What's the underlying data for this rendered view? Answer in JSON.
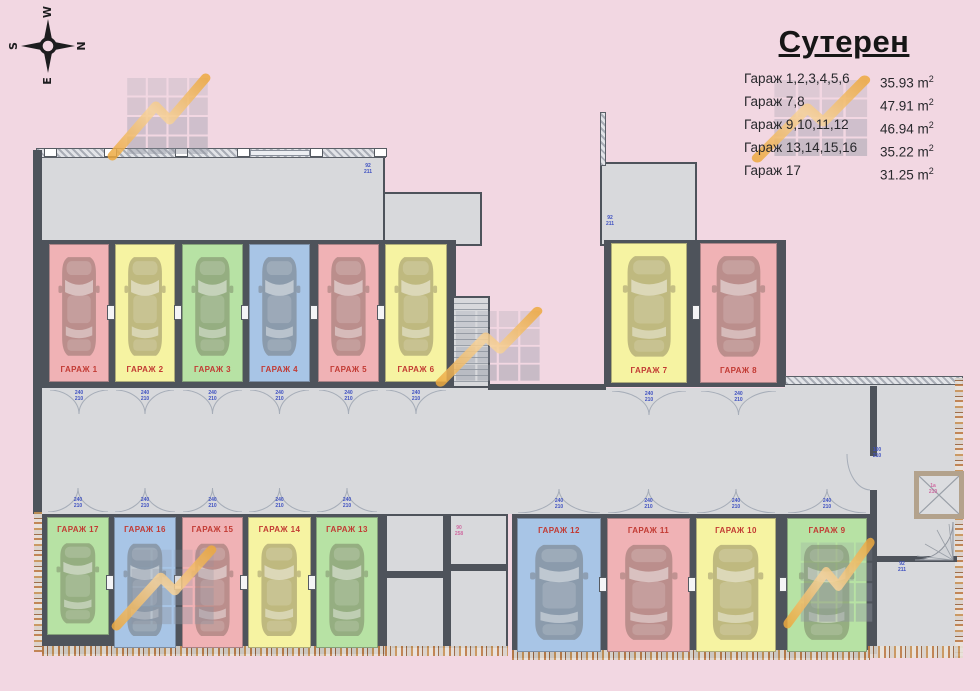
{
  "legend": {
    "title": "Сутерен",
    "unit": "m",
    "sup": "2",
    "rows": [
      {
        "label": "Гараж 1,2,3,4,5,6",
        "value": "35.93"
      },
      {
        "label": "Гараж 7,8",
        "value": "47.91"
      },
      {
        "label": "Гараж 9,10,11,12",
        "value": "46.94"
      },
      {
        "label": "Гараж 13,14,15,16",
        "value": "35.22"
      },
      {
        "label": "Гараж 17",
        "value": "31.25"
      }
    ]
  },
  "compass": {
    "top": "W",
    "right": "N",
    "bottom": "E",
    "left": "S"
  },
  "colors": {
    "red": "#f0b2b5",
    "yellow": "#f6f3a2",
    "green": "#b7e2a4",
    "blue": "#a8c5e6",
    "label": "#c23a33",
    "floor": "#d8d9dc",
    "wall": "#4e535b",
    "background": "#f2d7e2",
    "watermark_orange": "#eda93f",
    "dim_blue": "#3f51c1",
    "dim_pink": "#cf6aa0"
  },
  "plan": {
    "door_dim": "240\n210"
  },
  "garages": [
    {
      "id": 1,
      "label": "ГАРАЖ 1",
      "color": "red",
      "x": 49,
      "y": 244,
      "w": 60,
      "h": 138,
      "group": "tl",
      "label_pos": "bottom"
    },
    {
      "id": 2,
      "label": "ГАРАЖ 2",
      "color": "yellow",
      "x": 115,
      "y": 244,
      "w": 60,
      "h": 138,
      "group": "tl",
      "label_pos": "bottom"
    },
    {
      "id": 3,
      "label": "ГАРАЖ 3",
      "color": "green",
      "x": 182,
      "y": 244,
      "w": 61,
      "h": 138,
      "group": "tl",
      "label_pos": "bottom"
    },
    {
      "id": 4,
      "label": "ГАРАЖ 4",
      "color": "blue",
      "x": 249,
      "y": 244,
      "w": 61,
      "h": 138,
      "group": "tl",
      "label_pos": "bottom"
    },
    {
      "id": 5,
      "label": "ГАРАЖ 5",
      "color": "red",
      "x": 318,
      "y": 244,
      "w": 61,
      "h": 138,
      "group": "tl",
      "label_pos": "bottom"
    },
    {
      "id": 6,
      "label": "ГАРАЖ 6",
      "color": "yellow",
      "x": 385,
      "y": 244,
      "w": 62,
      "h": 138,
      "group": "tl",
      "label_pos": "bottom"
    },
    {
      "id": 7,
      "label": "ГАРАЖ 7",
      "color": "yellow",
      "x": 611,
      "y": 243,
      "w": 76,
      "h": 140,
      "group": "tr",
      "label_pos": "bottom"
    },
    {
      "id": 8,
      "label": "ГАРАЖ 8",
      "color": "red",
      "x": 700,
      "y": 243,
      "w": 77,
      "h": 140,
      "group": "tr",
      "label_pos": "bottom"
    },
    {
      "id": 17,
      "label": "ГАРАЖ 17",
      "color": "green",
      "x": 47,
      "y": 517,
      "w": 62,
      "h": 118,
      "group": "bl",
      "label_pos": "top"
    },
    {
      "id": 16,
      "label": "ГАРАЖ 16",
      "color": "blue",
      "x": 114,
      "y": 517,
      "w": 62,
      "h": 131,
      "group": "bl",
      "label_pos": "top"
    },
    {
      "id": 15,
      "label": "ГАРАЖ 15",
      "color": "red",
      "x": 182,
      "y": 517,
      "w": 61,
      "h": 131,
      "group": "bl",
      "label_pos": "top"
    },
    {
      "id": 14,
      "label": "ГАРАЖ 14",
      "color": "yellow",
      "x": 248,
      "y": 517,
      "w": 63,
      "h": 131,
      "group": "bl",
      "label_pos": "top"
    },
    {
      "id": 13,
      "label": "ГАРАЖ 13",
      "color": "green",
      "x": 316,
      "y": 517,
      "w": 62,
      "h": 131,
      "group": "bl",
      "label_pos": "top"
    },
    {
      "id": 12,
      "label": "ГАРАЖ 12",
      "color": "blue",
      "x": 517,
      "y": 518,
      "w": 84,
      "h": 134,
      "group": "br",
      "label_pos": "top"
    },
    {
      "id": 11,
      "label": "ГАРАЖ 11",
      "color": "red",
      "x": 607,
      "y": 518,
      "w": 83,
      "h": 134,
      "group": "br",
      "label_pos": "top"
    },
    {
      "id": 10,
      "label": "ГАРАЖ 10",
      "color": "yellow",
      "x": 696,
      "y": 518,
      "w": 80,
      "h": 134,
      "group": "br",
      "label_pos": "top"
    },
    {
      "id": 9,
      "label": "ГАРАЖ 9",
      "color": "green",
      "x": 787,
      "y": 518,
      "w": 80,
      "h": 134,
      "group": "br",
      "label_pos": "top"
    }
  ],
  "dim_labels": [
    {
      "x": 368,
      "y": 164,
      "text": "92\n211",
      "c": "blue"
    },
    {
      "x": 610,
      "y": 216,
      "text": "92\n211",
      "c": "blue"
    },
    {
      "x": 877,
      "y": 448,
      "text": "100\n210",
      "c": "blue"
    },
    {
      "x": 902,
      "y": 562,
      "text": "92\n211",
      "c": "blue"
    },
    {
      "x": 933,
      "y": 484,
      "text": "1a\n210",
      "c": "pink"
    },
    {
      "x": 459,
      "y": 526,
      "text": "90\n258",
      "c": "pink"
    }
  ],
  "watermarks": [
    {
      "x": 106,
      "y": 66,
      "w": 106,
      "h": 96,
      "flip": false
    },
    {
      "x": 750,
      "y": 68,
      "w": 122,
      "h": 96,
      "flip": false
    },
    {
      "x": 434,
      "y": 300,
      "w": 110,
      "h": 88,
      "flip": false
    },
    {
      "x": 110,
      "y": 538,
      "w": 108,
      "h": 94,
      "flip": false
    },
    {
      "x": 782,
      "y": 530,
      "w": 94,
      "h": 100,
      "flip": false
    }
  ]
}
